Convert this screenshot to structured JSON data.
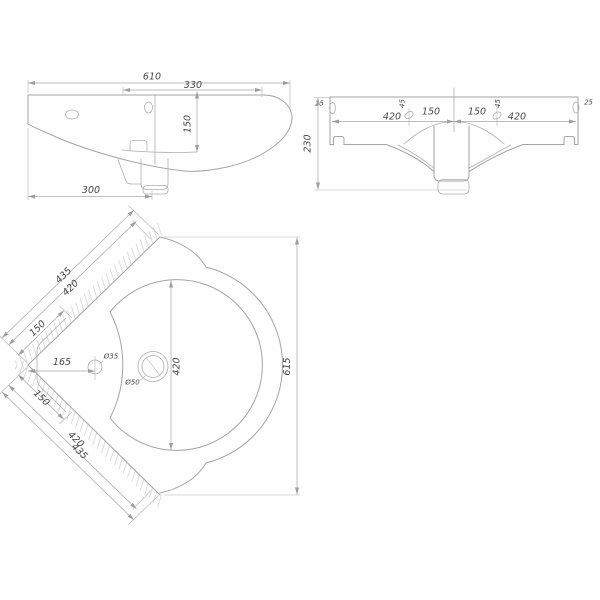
{
  "drawing": {
    "background": "#fefefe",
    "line_color": "#a4a4a4",
    "text_color": "#474747",
    "views": {
      "front": {
        "label": "front-elevation",
        "dims": {
          "overall_width": "610",
          "right_section": "330",
          "rim_to_deck": "150",
          "left_to_drain": "300"
        }
      },
      "rear": {
        "label": "rear-elevation",
        "dims": {
          "left_edge_offset": "25",
          "left_hole_span": "420",
          "left_hole_drop": "45",
          "left_center_span": "150",
          "right_center_span": "150",
          "right_hole_drop": "45",
          "right_hole_span": "420",
          "right_edge_offset": "25",
          "overall_height": "230"
        }
      },
      "plan": {
        "label": "plan-view",
        "dims": {
          "upper_wall_outer": "435",
          "upper_wall_inner": "420",
          "upper_corner_span": "150",
          "faucet_offset": "165",
          "faucet_hole_dia": "Ø35",
          "drain_dia": "Ø50",
          "bowl_width": "420",
          "overall_depth": "615",
          "lower_corner_span": "150",
          "lower_wall_inner": "420",
          "lower_wall_outer": "435"
        }
      }
    }
  }
}
